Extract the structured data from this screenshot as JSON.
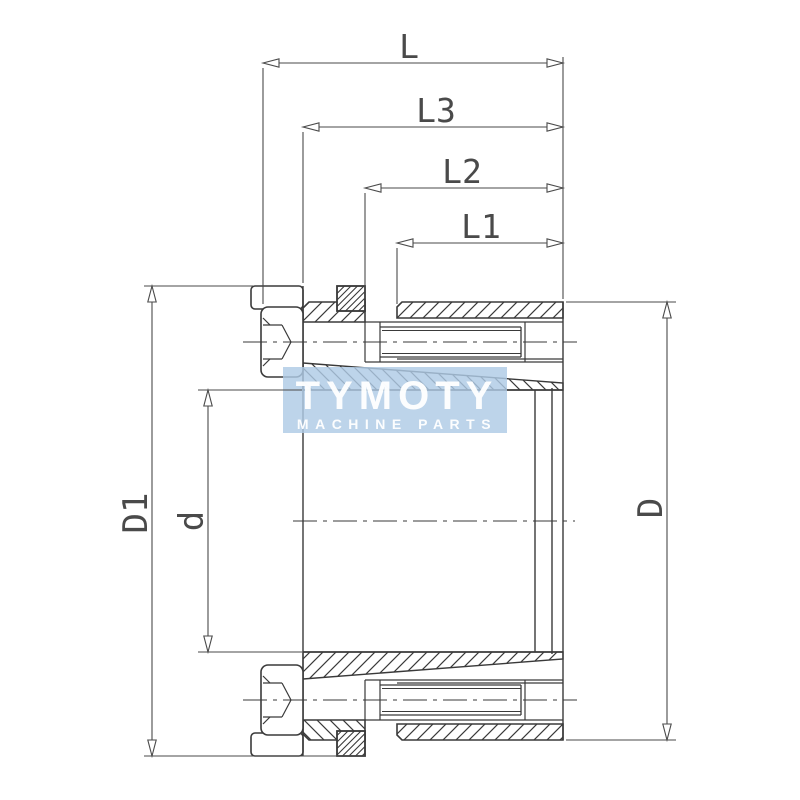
{
  "dimensions": {
    "total_length": "L",
    "length_l3": "L3",
    "length_l2": "L2",
    "length_l1": "L1",
    "flange_outer_diameter": "D1",
    "bore_diameter": "d",
    "sleeve_outer_diameter": "D"
  },
  "watermark": {
    "brand": "TYMOTY",
    "tagline": "MACHINE PARTS"
  },
  "colors": {
    "line": "#3a3a3a",
    "dim_line": "#4a4a4a",
    "watermark_panel": "#aecbe5",
    "watermark_text": "#ffffff",
    "background": "#ffffff"
  }
}
